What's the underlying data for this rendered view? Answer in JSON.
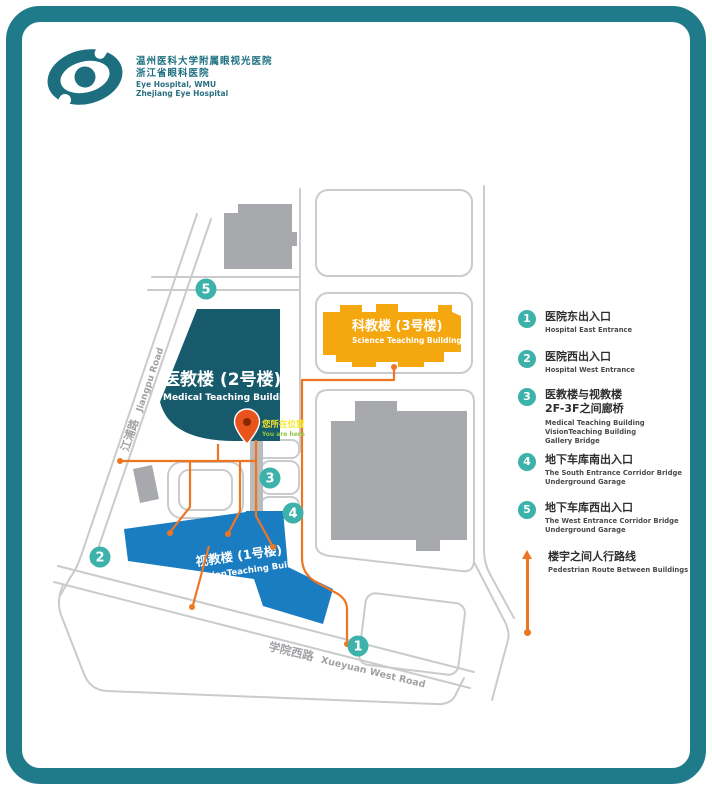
{
  "colors": {
    "frame_teal": "#1F7A8A",
    "marker_teal": "#3DB2AB",
    "route_orange": "#EE7623",
    "building_medical": "#175A6C",
    "building_science": "#F5A70F",
    "building_vision": "#1A7CC1",
    "building_gray": "#A7A9AC",
    "road_gray": "#C9CBCD",
    "pin_red": "#E8541C",
    "pin_label_yellow": "#F7E72A"
  },
  "logo": {
    "zh1": "温州医科大学附属眼视光医院",
    "zh2": "浙江省眼科医院",
    "en1": "Eye Hospital, WMU",
    "en2": "Zhejiang Eye Hospital"
  },
  "map": {
    "buildings": {
      "medical": {
        "zh": "医教楼 (2号楼)",
        "en": "Medical Teaching Building"
      },
      "science": {
        "zh": "科教楼 (3号楼)",
        "en": "Science Teaching Building"
      },
      "vision": {
        "zh": "视教楼 (1号楼)",
        "en": "VisionTeaching Building"
      }
    },
    "roads": {
      "west": {
        "zh": "江浦路",
        "en": "Jiangpu Road"
      },
      "south": {
        "zh": "学院西路",
        "en": "Xueyuan West Road"
      }
    },
    "pin": {
      "zh": "您所在位置",
      "en": "You are here"
    },
    "marker_nums": [
      "1",
      "2",
      "3",
      "4",
      "5"
    ]
  },
  "legend": {
    "items": [
      {
        "num": "1",
        "title_lines": [
          "医院东出入口"
        ],
        "en_lines": [
          "Hospital East Entrance"
        ]
      },
      {
        "num": "2",
        "title_lines": [
          "医院西出入口"
        ],
        "en_lines": [
          "Hospital West Entrance"
        ]
      },
      {
        "num": "3",
        "title_lines": [
          "医教楼与视教楼",
          "2F-3F之间廊桥"
        ],
        "en_lines": [
          "Medical Teaching Building",
          "VisionTeaching Building",
          "Gallery Bridge"
        ]
      },
      {
        "num": "4",
        "title_lines": [
          "地下车库南出入口"
        ],
        "en_lines": [
          "The South Entrance Corridor Bridge",
          "Underground Garage"
        ]
      },
      {
        "num": "5",
        "title_lines": [
          "地下车库西出入口"
        ],
        "en_lines": [
          "The West Entrance Corridor Bridge",
          "Underground Garage"
        ]
      }
    ],
    "route": {
      "title": "楼宇之间人行路线",
      "en": "Pedestrian Route Between Buildings"
    }
  }
}
